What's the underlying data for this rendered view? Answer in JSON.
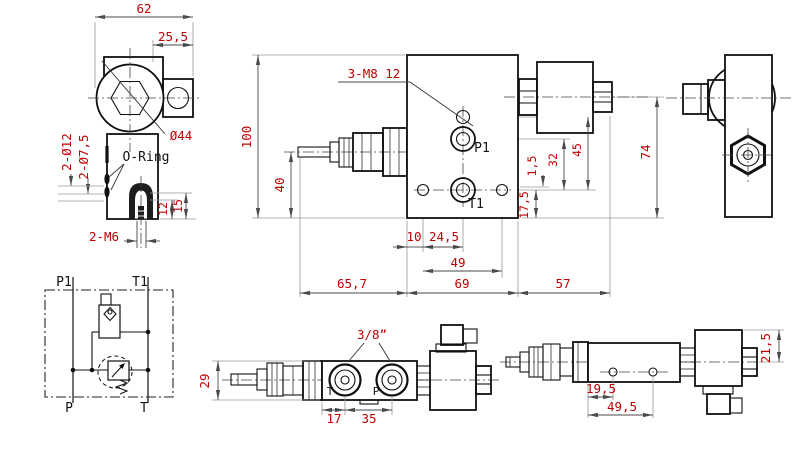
{
  "drawing": {
    "type": "technical-orthographic-drawing",
    "subject": "solenoid operated hydraulic valve with relief adjustment",
    "colors": {
      "line": "#111111",
      "dimension_text": "#c00000",
      "background": "#ffffff"
    },
    "views": {
      "topView": {
        "dim62": "62",
        "dim255": "25,5",
        "dia44": "Ø44",
        "holes12": "2-Ø12",
        "holes75": "2-Ø7,5",
        "oring": "O-Ring",
        "dim12": "12",
        "dim15": "15",
        "m6": "2-M6"
      },
      "frontView": {
        "dim100": "100",
        "dim40": "40",
        "m8": "3-M8 12",
        "p1": "P1",
        "t1": "T1",
        "dim10": "10",
        "dim245": "24,5",
        "dim49": "49",
        "dim657": "65,7",
        "dim69": "69",
        "dim57": "57",
        "dim175": "17,5",
        "dim15b": "1,5",
        "dim32": "32",
        "dim45": "45",
        "dim74": "74"
      },
      "schematic": {
        "p1": "P1",
        "t1": "T1",
        "p": "P",
        "t": "T"
      },
      "bottomView": {
        "dim29": "29",
        "thread": "3/8”",
        "portT": "T",
        "portP": "P",
        "dim17": "17",
        "dim35": "35"
      },
      "sideView": {
        "dim195": "19,5",
        "dim495": "49,5",
        "dim215": "21,5"
      }
    }
  }
}
